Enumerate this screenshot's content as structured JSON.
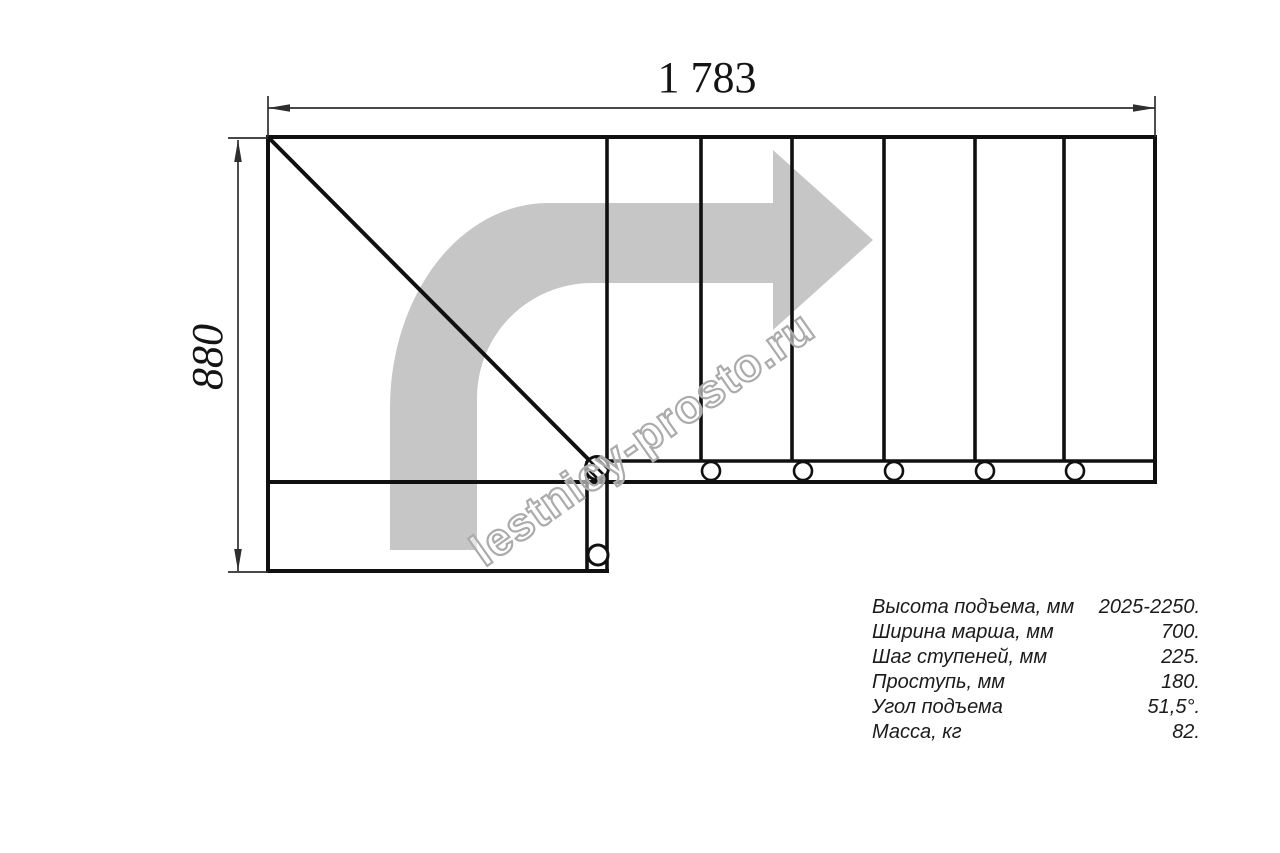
{
  "drawing": {
    "dimension_width": "1 783",
    "dimension_height": "880",
    "watermark": "lestnicy-prosto.ru"
  },
  "specs": {
    "rows": [
      {
        "label": "Высота подъема, мм",
        "value": "2025-2250."
      },
      {
        "label": "Ширина марша, мм",
        "value": "700."
      },
      {
        "label": "Шаг ступеней, мм",
        "value": "225."
      },
      {
        "label": "Проступь, мм",
        "value": "180."
      },
      {
        "label": "Угол подъема",
        "value": "51,5°."
      },
      {
        "label": "Масса, кг",
        "value": "82."
      }
    ]
  },
  "colors": {
    "line_black": "#101010",
    "dimension_gray": "#2e2e2e",
    "arrow_gray": "#c6c6c6",
    "watermark_gray": "#ababab",
    "background": "#ffffff"
  }
}
